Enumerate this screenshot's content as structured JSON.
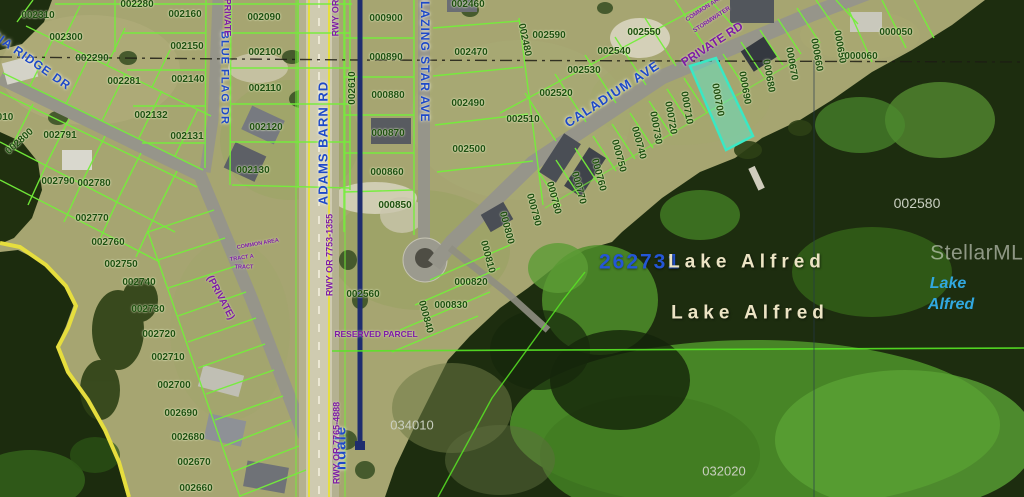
{
  "map": {
    "watermark": "StellarMLS",
    "highlighted_parcel": {
      "id": "000700",
      "color": "#3ae8c4"
    },
    "colors": {
      "parcel_line": "#74ef3a",
      "boundary_navy": "#1f2d6e",
      "shore_yellow": "#e6de3e",
      "highlight": "#3ae8c4",
      "street_text": "#1e49c8",
      "annotation_purple": "#7d1ba6"
    },
    "labels": {
      "parcel": [
        {
          "t": "002310",
          "x": 38,
          "y": 16
        },
        {
          "t": "002300",
          "x": 66,
          "y": 38
        },
        {
          "t": "002290",
          "x": 92,
          "y": 59
        },
        {
          "t": "002280",
          "x": 137,
          "y": 5
        },
        {
          "t": "002281",
          "x": 124,
          "y": 82
        },
        {
          "t": "002160",
          "x": 185,
          "y": 15
        },
        {
          "t": "002150",
          "x": 187,
          "y": 47
        },
        {
          "t": "002140",
          "x": 188,
          "y": 80
        },
        {
          "t": "002132",
          "x": 151,
          "y": 116
        },
        {
          "t": "002131",
          "x": 187,
          "y": 137
        },
        {
          "t": "002090",
          "x": 264,
          "y": 18
        },
        {
          "t": "002100",
          "x": 265,
          "y": 53
        },
        {
          "t": "002110",
          "x": 265,
          "y": 89
        },
        {
          "t": "002120",
          "x": 266,
          "y": 128
        },
        {
          "t": "002130",
          "x": 253,
          "y": 171
        },
        {
          "t": "010",
          "x": 5,
          "y": 118
        },
        {
          "t": "002800",
          "x": 20,
          "y": 142,
          "r": -42
        },
        {
          "t": "002791",
          "x": 60,
          "y": 136
        },
        {
          "t": "002790",
          "x": 58,
          "y": 182
        },
        {
          "t": "002780",
          "x": 94,
          "y": 184
        },
        {
          "t": "002770",
          "x": 92,
          "y": 219
        },
        {
          "t": "002760",
          "x": 108,
          "y": 243
        },
        {
          "t": "002750",
          "x": 121,
          "y": 265
        },
        {
          "t": "002740",
          "x": 139,
          "y": 283
        },
        {
          "t": "002730",
          "x": 148,
          "y": 310
        },
        {
          "t": "002720",
          "x": 159,
          "y": 335
        },
        {
          "t": "002710",
          "x": 168,
          "y": 358
        },
        {
          "t": "002700",
          "x": 174,
          "y": 386
        },
        {
          "t": "002690",
          "x": 181,
          "y": 414
        },
        {
          "t": "002680",
          "x": 188,
          "y": 438
        },
        {
          "t": "002670",
          "x": 194,
          "y": 463
        },
        {
          "t": "002660",
          "x": 196,
          "y": 489
        },
        {
          "t": "000900",
          "x": 386,
          "y": 19
        },
        {
          "t": "000890",
          "x": 386,
          "y": 58
        },
        {
          "t": "000880",
          "x": 388,
          "y": 96
        },
        {
          "t": "000870",
          "x": 388,
          "y": 134
        },
        {
          "t": "000860",
          "x": 387,
          "y": 173
        },
        {
          "t": "000850",
          "x": 395,
          "y": 206
        },
        {
          "t": "002610",
          "x": 353,
          "y": 88,
          "r": -90
        },
        {
          "t": "002460",
          "x": 468,
          "y": 5
        },
        {
          "t": "002470",
          "x": 471,
          "y": 53
        },
        {
          "t": "002480",
          "x": 524,
          "y": 40,
          "r": 78
        },
        {
          "t": "002490",
          "x": 468,
          "y": 104
        },
        {
          "t": "002500",
          "x": 469,
          "y": 150
        },
        {
          "t": "002590",
          "x": 549,
          "y": 36
        },
        {
          "t": "002510",
          "x": 523,
          "y": 120
        },
        {
          "t": "002520",
          "x": 556,
          "y": 94
        },
        {
          "t": "002530",
          "x": 584,
          "y": 71
        },
        {
          "t": "002540",
          "x": 614,
          "y": 52
        },
        {
          "t": "002550",
          "x": 644,
          "y": 33
        },
        {
          "t": "002560",
          "x": 363,
          "y": 295
        },
        {
          "t": "000810",
          "x": 487,
          "y": 257,
          "r": 75
        },
        {
          "t": "000820",
          "x": 471,
          "y": 283
        },
        {
          "t": "000830",
          "x": 451,
          "y": 306
        },
        {
          "t": "000840",
          "x": 425,
          "y": 317,
          "r": 75
        },
        {
          "t": "000800",
          "x": 506,
          "y": 228,
          "r": 75
        },
        {
          "t": "000790",
          "x": 533,
          "y": 210,
          "r": 75
        },
        {
          "t": "000780",
          "x": 553,
          "y": 198,
          "r": 75
        },
        {
          "t": "000770",
          "x": 578,
          "y": 188,
          "r": 75
        },
        {
          "t": "000760",
          "x": 598,
          "y": 175,
          "r": 75
        },
        {
          "t": "000750",
          "x": 618,
          "y": 156,
          "r": 75
        },
        {
          "t": "000740",
          "x": 638,
          "y": 143,
          "r": 75
        },
        {
          "t": "000730",
          "x": 655,
          "y": 128,
          "r": 80
        },
        {
          "t": "000720",
          "x": 670,
          "y": 118,
          "r": 80
        },
        {
          "t": "000710",
          "x": 686,
          "y": 108,
          "r": 80
        },
        {
          "t": "000700",
          "x": 717,
          "y": 100,
          "r": 80
        },
        {
          "t": "000690",
          "x": 744,
          "y": 88,
          "r": 80
        },
        {
          "t": "000680",
          "x": 768,
          "y": 76,
          "r": 80
        },
        {
          "t": "000670",
          "x": 791,
          "y": 64,
          "r": 80
        },
        {
          "t": "000660",
          "x": 816,
          "y": 55,
          "r": 80
        },
        {
          "t": "000650",
          "x": 839,
          "y": 47,
          "r": 80
        },
        {
          "t": "000050",
          "x": 896,
          "y": 33
        },
        {
          "t": "000060",
          "x": 861,
          "y": 57
        }
      ],
      "street": [
        {
          "t": "CIA RIDGE DR",
          "x": 31,
          "y": 60,
          "r": 35,
          "c": "s",
          "s": 12
        },
        {
          "t": "BLUE FLAG DR",
          "x": 224,
          "y": 78,
          "r": 90,
          "c": "s",
          "s": 11
        },
        {
          "t": "ADAMS BARN RD",
          "x": 323,
          "y": 143,
          "r": -90,
          "c": "s",
          "s": 13
        },
        {
          "t": "BLAZING STAR AVE",
          "x": 425,
          "y": 57,
          "r": 90,
          "c": "s",
          "s": 12
        },
        {
          "t": "CALADIUM AVE",
          "x": 612,
          "y": 94,
          "r": -33,
          "c": "s",
          "s": 13
        },
        {
          "t": "ndale",
          "x": 341,
          "y": 448,
          "r": -90,
          "c": "s",
          "s": 15
        }
      ],
      "annotation": [
        {
          "t": "PRIVATE RD",
          "x": 712,
          "y": 44,
          "r": -33,
          "c": "pu",
          "s": 12
        },
        {
          "t": "(PRIVATE",
          "x": 227,
          "y": 16,
          "r": 90,
          "c": "pu",
          "s": 9
        },
        {
          "t": "(PRIVATE)",
          "x": 220,
          "y": 298,
          "r": 62,
          "c": "pu",
          "s": 10
        },
        {
          "t": "RWY OR",
          "x": 336,
          "y": 18,
          "r": -90,
          "c": "pu",
          "s": 9
        },
        {
          "t": "RWY OR 7753-1355",
          "x": 330,
          "y": 255,
          "r": -90,
          "c": "pu",
          "s": 9
        },
        {
          "t": "RWY OR 7765-4888",
          "x": 337,
          "y": 443,
          "r": -90,
          "c": "pu",
          "s": 9
        },
        {
          "t": "COMMON AREA",
          "x": 258,
          "y": 245,
          "r": -10,
          "c": "pu",
          "s": 5.5
        },
        {
          "t": "TRACT A",
          "x": 242,
          "y": 259,
          "r": -8,
          "c": "pu",
          "s": 5.5
        },
        {
          "t": "TRACT",
          "x": 244,
          "y": 268,
          "r": 0,
          "c": "pu",
          "s": 5.5
        },
        {
          "t": "COMMON AREA",
          "x": 706,
          "y": 8,
          "r": -33,
          "c": "pu",
          "s": 6
        },
        {
          "t": "STORMWATER",
          "x": 712,
          "y": 20,
          "r": -33,
          "c": "pu",
          "s": 6
        },
        {
          "t": "RESERVED PARCEL",
          "x": 376,
          "y": 334,
          "r": 0,
          "c": "pu",
          "s": 8.5
        }
      ],
      "water": [
        {
          "t": "002580",
          "x": 917,
          "y": 203,
          "c": "g",
          "s": 14
        },
        {
          "t": "034010",
          "x": 412,
          "y": 425,
          "c": "g",
          "s": 13
        },
        {
          "t": "032020",
          "x": 724,
          "y": 471,
          "c": "g",
          "s": 13
        },
        {
          "t": "262731",
          "x": 640,
          "y": 262,
          "c": "num",
          "s": 21,
          "ls": 2
        },
        {
          "t": "Lake Alfred",
          "x": 747,
          "y": 262,
          "c": "lake",
          "s": 19,
          "ls": 5
        },
        {
          "t": "Lake Alfred",
          "x": 750,
          "y": 313,
          "c": "lake",
          "s": 19,
          "ls": 5
        },
        {
          "t": "Lake",
          "x": 948,
          "y": 284,
          "c": "lakec",
          "s": 16
        },
        {
          "t": "Alfred",
          "x": 951,
          "y": 305,
          "c": "lakec",
          "s": 16
        }
      ]
    }
  }
}
